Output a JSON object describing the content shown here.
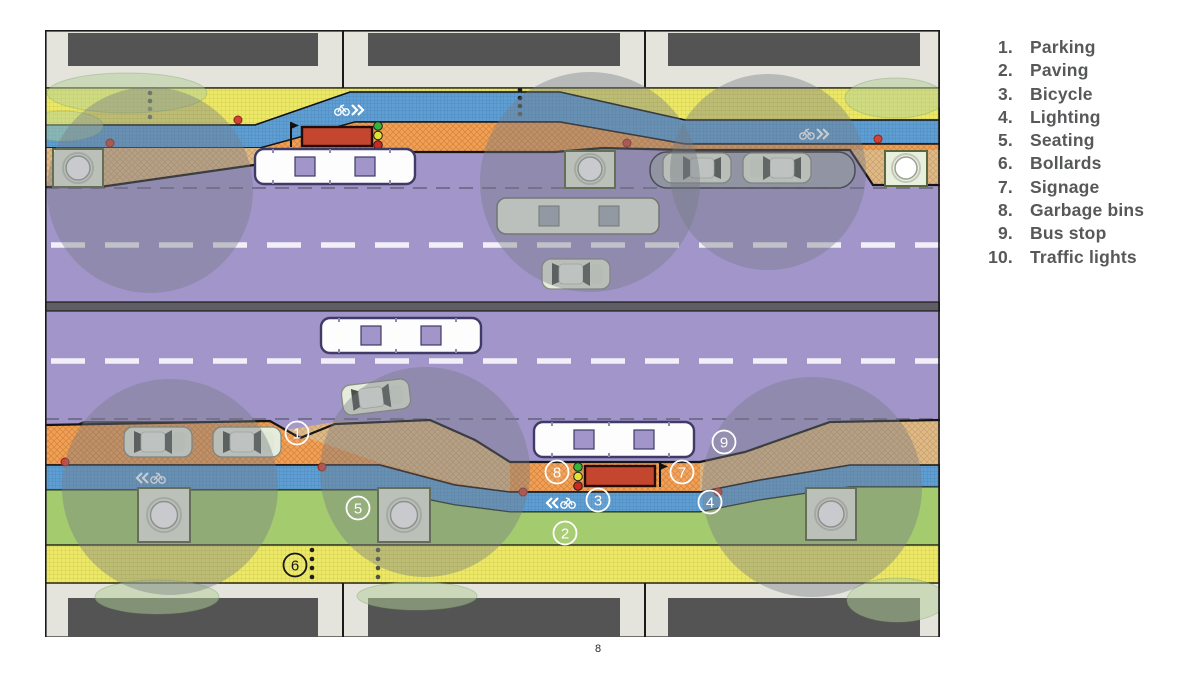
{
  "page": {
    "number": "8"
  },
  "legend": {
    "items": [
      {
        "num": "1.",
        "label": "Parking"
      },
      {
        "num": "2.",
        "label": "Paving"
      },
      {
        "num": "3.",
        "label": "Bicycle"
      },
      {
        "num": "4.",
        "label": "Lighting"
      },
      {
        "num": "5.",
        "label": "Seating"
      },
      {
        "num": "6.",
        "label": "Bollards"
      },
      {
        "num": "7.",
        "label": "Signage"
      },
      {
        "num": "8.",
        "label": "Garbage bins"
      },
      {
        "num": "9.",
        "label": "Bus stop"
      },
      {
        "num": "10.",
        "label": "Traffic lights"
      }
    ]
  },
  "plan": {
    "annotations": [
      {
        "label": "1",
        "transform": "translate(252,403)",
        "theme": "light"
      },
      {
        "label": "2",
        "transform": "translate(520,503)",
        "theme": "light"
      },
      {
        "label": "3",
        "transform": "translate(553,470)",
        "theme": "light"
      },
      {
        "label": "4",
        "transform": "translate(665,472)",
        "theme": "light"
      },
      {
        "label": "5",
        "transform": "translate(313,478)",
        "theme": "light"
      },
      {
        "label": "6",
        "transform": "translate(250,535)",
        "theme": "dark"
      },
      {
        "label": "7",
        "transform": "translate(637,442)",
        "theme": "light"
      },
      {
        "label": "8",
        "transform": "translate(512,442)",
        "theme": "light"
      },
      {
        "label": "9",
        "transform": "translate(679,412)",
        "theme": "light"
      }
    ],
    "colors": {
      "roadway": "#a295ca",
      "bike_lane": "#5f9ed2",
      "sidewalk_paving": "#ece969",
      "parking_strip": "#f2a058",
      "green_strip": "#a3ca6c",
      "building": "#545454",
      "bus_shelter": "#c4462f",
      "lighting_overlay": "#767a84",
      "traffic_light_green": "#35b53a",
      "traffic_light_yellow": "#e5e02f",
      "traffic_light_red": "#cf2a20"
    }
  }
}
